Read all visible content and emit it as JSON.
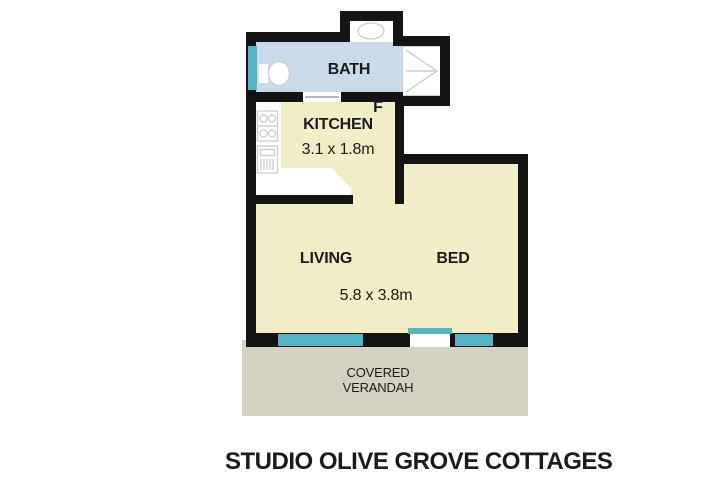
{
  "title": "STUDIO OLIVE GROVE COTTAGES",
  "plan": {
    "bath": {
      "label": "BATH"
    },
    "kitchen": {
      "label": "KITCHEN",
      "dimensions": "3.1 x 1.8m",
      "fridge_label": "F"
    },
    "living": {
      "label": "LIVING"
    },
    "bed": {
      "label": "BED"
    },
    "main_dimensions": "5.8 x 3.8m",
    "verandah": {
      "label_line1": "COVERED",
      "label_line2": "VERANDAH"
    }
  },
  "fixtures": {
    "toilet": "toilet-icon",
    "basin": "basin-icon",
    "shower": "shower-icon",
    "cooktop": "cooktop-icon",
    "oven": "oven-icon"
  },
  "colors": {
    "wall": "#141414",
    "bath_floor": "#c9dbea",
    "room_floor": "#f2edc9",
    "verandah_floor": "#d5d1c1",
    "window": "#54b6c5",
    "fixture_outline": "#ccd1d4",
    "door_line": "#b3b8bb",
    "text": "#1b1b1b"
  }
}
